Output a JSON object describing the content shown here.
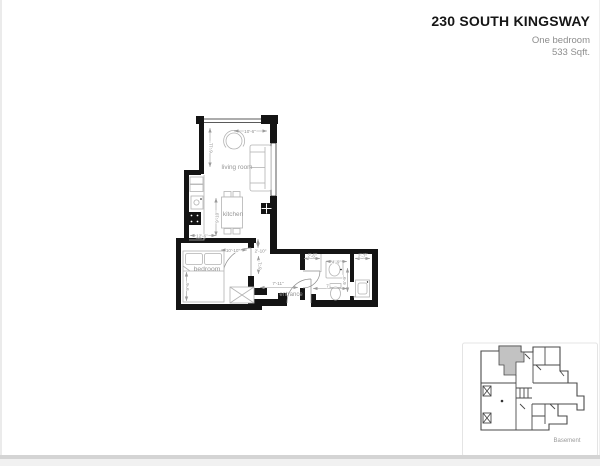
{
  "header": {
    "title": "230 SOUTH KINGSWAY",
    "subtitle_line1": "One bedroom",
    "subtitle_line2": "533 Sqft."
  },
  "floorplan": {
    "room_labels": {
      "living_room": "living room",
      "kitchen": "kitchen",
      "bedroom": "bedroom",
      "entrance": "entrance"
    },
    "dims": {
      "living_width": "10'-6\"",
      "living_height": "6'-11\"",
      "kitchen_height": "9'-10\"",
      "kitchen_width": "12'-6\"",
      "bedroom_width": "10'-10\"",
      "bedroom_height": "9'-6\"",
      "bedroom_door_height": "8'-1\"",
      "hall_width": "2'-10\"",
      "entrance_width": "7'-11\"",
      "bathroom_length": "7'",
      "bathroom_nook_width": "2'-6\"",
      "bathroom_width": "4'-9\"",
      "laundry_closet_width": "2'-7\"",
      "bathroom_height": "6'-9\""
    }
  },
  "keyplan": {
    "floor_label": "Basement"
  },
  "colors": {
    "wall": "#141414",
    "dim_text": "#8f8f8f",
    "title": "#161616",
    "subtitle": "#8d8d8d",
    "keyplan_highlight": "#c2c2c2"
  }
}
